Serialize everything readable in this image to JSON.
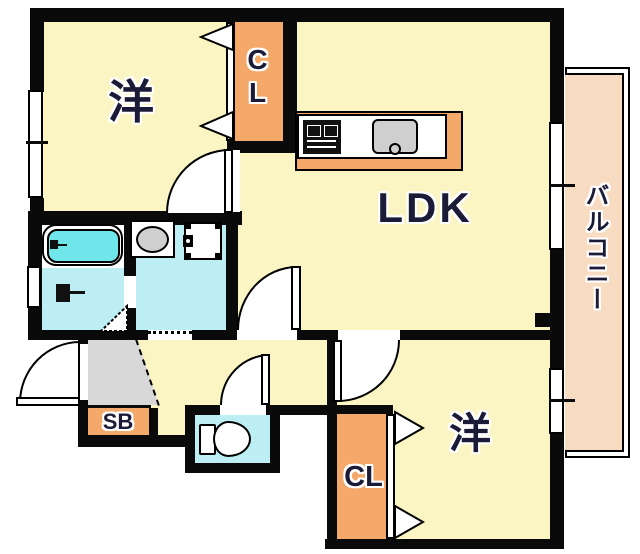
{
  "floorplan": {
    "title": "apartment-floor-plan",
    "rooms": {
      "bedroom1": {
        "label": "洋"
      },
      "closet1": {
        "label": "CL"
      },
      "ldk": {
        "label": "LDK"
      },
      "balcony": {
        "label": "バルコニー"
      },
      "bedroom2": {
        "label": "洋"
      },
      "closet2": {
        "label": "CL"
      },
      "shoe_box": {
        "label": "SB"
      }
    },
    "fixtures": [
      "bathtub",
      "shower",
      "vanity-sink",
      "washing-machine-pan",
      "toilet",
      "kitchen-stove",
      "kitchen-sink"
    ],
    "colors": {
      "room_yellow": "#FAF5C2",
      "closet_orange": "#F4A96B",
      "balcony_peach": "#F8DCC2",
      "tub_cyan": "#6FE6E9",
      "wet_floor_cyan": "#BCEEF4",
      "genkan_gray": "#D8D8D8",
      "wall_black": "#0A0A0A",
      "text_navy": "#1B1B38"
    }
  }
}
